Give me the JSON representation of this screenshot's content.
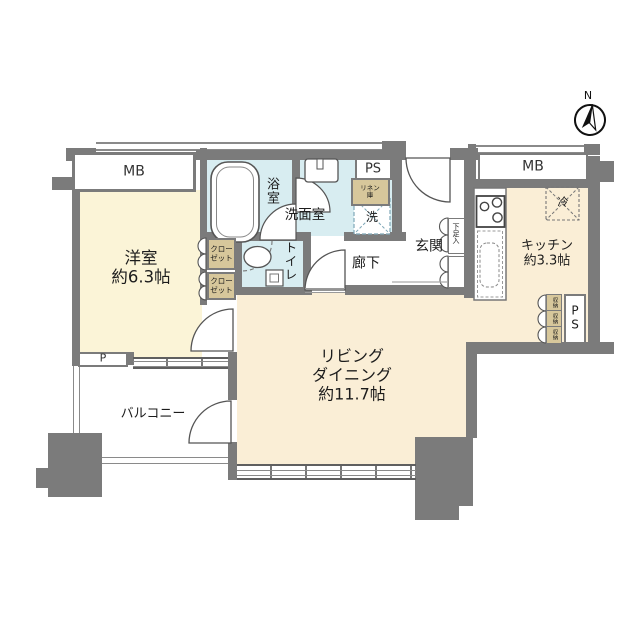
{
  "compass": {
    "north": "N"
  },
  "rooms": {
    "western_room": {
      "name": "洋室",
      "area": "約6.3帖"
    },
    "living_dining": {
      "line1": "リビング",
      "line2": "ダイニング",
      "area": "約11.7帖"
    },
    "kitchen": {
      "name": "キッチン",
      "area": "約3.3帖"
    },
    "bathroom": {
      "name": "浴室"
    },
    "washroom": {
      "name": "洗面室"
    },
    "toilet": {
      "name": "トイレ"
    },
    "hallway": {
      "name": "廊下"
    },
    "entrance": {
      "name": "玄関"
    },
    "balcony": {
      "name": "バルコニー"
    }
  },
  "fixtures": {
    "meter_box": "MB",
    "pipe_space": "PS",
    "pump_label": "P",
    "linen_line1": "リネン",
    "linen_line2": "庫",
    "closet_line1": "クロー",
    "closet_line2": "ゼット",
    "shoe_cabinet": "下足入",
    "washer": "洗",
    "fridge": "冷",
    "storage": "収納"
  },
  "colors": {
    "wall": "#7b7b7b",
    "room_cream": "#faeed6",
    "room_yellow": "#fbf4d7",
    "wet_blue": "#d8edf1",
    "closet_tan": "#d7c79b"
  }
}
